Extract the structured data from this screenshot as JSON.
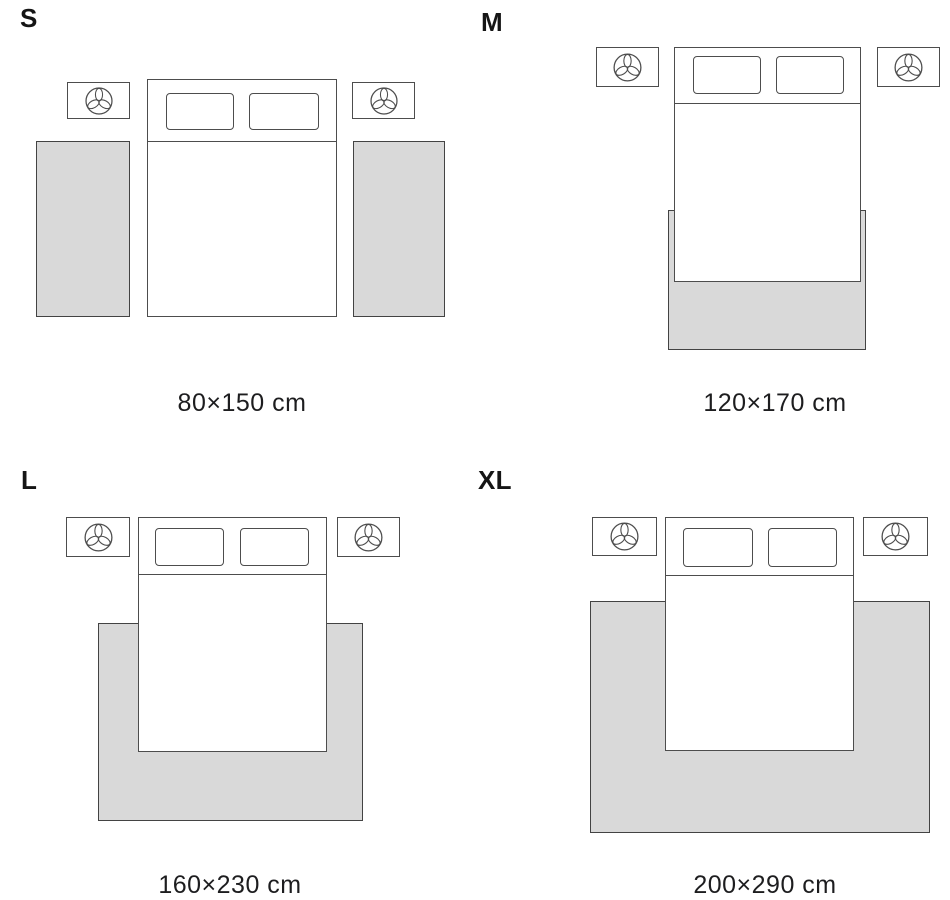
{
  "variants": [
    {
      "label": "S",
      "size": "80×150 cm"
    },
    {
      "label": "M",
      "size": "120×170 cm"
    },
    {
      "label": "L",
      "size": "160×230 cm"
    },
    {
      "label": "XL",
      "size": "200×290 cm"
    }
  ],
  "icons": {
    "nightstand_decoration": "plant-icon"
  },
  "colors": {
    "background": "#ffffff",
    "rug_fill": "#d9d9d9",
    "outline": "#4a4a4a",
    "text": "#1a1a1a"
  }
}
